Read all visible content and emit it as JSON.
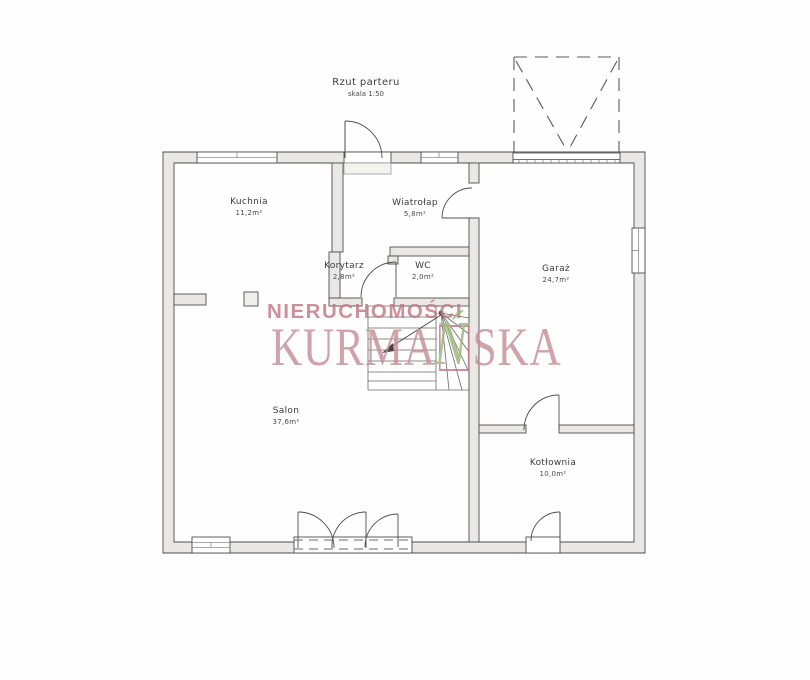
{
  "title": {
    "text": "Rzut parteru",
    "scale": "skala 1:50"
  },
  "rooms": [
    {
      "id": "kuchnia",
      "name": "Kuchnia",
      "area": "11,2m²"
    },
    {
      "id": "wiatrolap",
      "name": "Wiatrołap",
      "area": "5,8m²"
    },
    {
      "id": "korytarz",
      "name": "Korytarz",
      "area": "2,8m²"
    },
    {
      "id": "wc",
      "name": "WC",
      "area": "2,0m²"
    },
    {
      "id": "garaz",
      "name": "Garaż",
      "area": "24,7m²"
    },
    {
      "id": "salon",
      "name": "Salon",
      "area": "37,6m²"
    },
    {
      "id": "kotlownia",
      "name": "Kotłownia",
      "area": "10,0m²"
    }
  ],
  "watermark": {
    "line1": "NIERUCHOMOŚCI",
    "line2_prefix": "KURMA",
    "line2_accent_letter": "Ń",
    "line2_suffix": "SKA",
    "colors": {
      "line1_text": "#c27983",
      "line2_text": "#c78f98",
      "accent_letter": "#9db77c",
      "accent_box_border": "#c4798a"
    }
  }
}
